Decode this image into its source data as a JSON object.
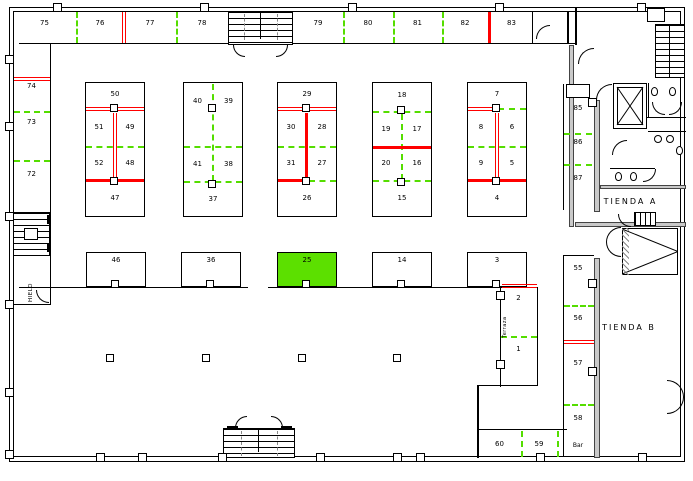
{
  "plan": {
    "colors": {
      "wall": "#000000",
      "occupied_divider": "#ff0000",
      "free_divider": "#55dd00",
      "selected_fill": "#5ce000",
      "service_wall": "#c9c9c9"
    },
    "rooms": {
      "tienda_a": "TIENDA A",
      "tienda_b": "TIENDA B",
      "hielo": "HIELO",
      "terraza": "Terraza",
      "bar": "Bar"
    },
    "selected_stall": "25",
    "top_row": [
      "75",
      "76",
      "77",
      "78",
      "79",
      "80",
      "81",
      "82",
      "83"
    ],
    "left_column": [
      "74",
      "73",
      "72"
    ],
    "islands": [
      {
        "cells": [
          "50",
          "51",
          "49",
          "52",
          "48",
          "47"
        ]
      },
      {
        "cells": [
          "40",
          "39",
          "41",
          "38",
          "37"
        ]
      },
      {
        "cells": [
          "29",
          "30",
          "28",
          "31",
          "27",
          "26"
        ]
      },
      {
        "cells": [
          "18",
          "19",
          "17",
          "20",
          "16",
          "15"
        ]
      },
      {
        "cells": [
          "7",
          "8",
          "6",
          "9",
          "5",
          "4"
        ]
      }
    ],
    "mid_row": [
      "46",
      "36",
      "25",
      "14",
      "3"
    ],
    "terrace_stalls": [
      "2",
      "1"
    ],
    "right_column_upper": [
      "85",
      "86",
      "87"
    ],
    "right_column_lower": [
      "55",
      "56",
      "57",
      "58"
    ],
    "bottom_right_row": [
      "60",
      "59"
    ]
  }
}
